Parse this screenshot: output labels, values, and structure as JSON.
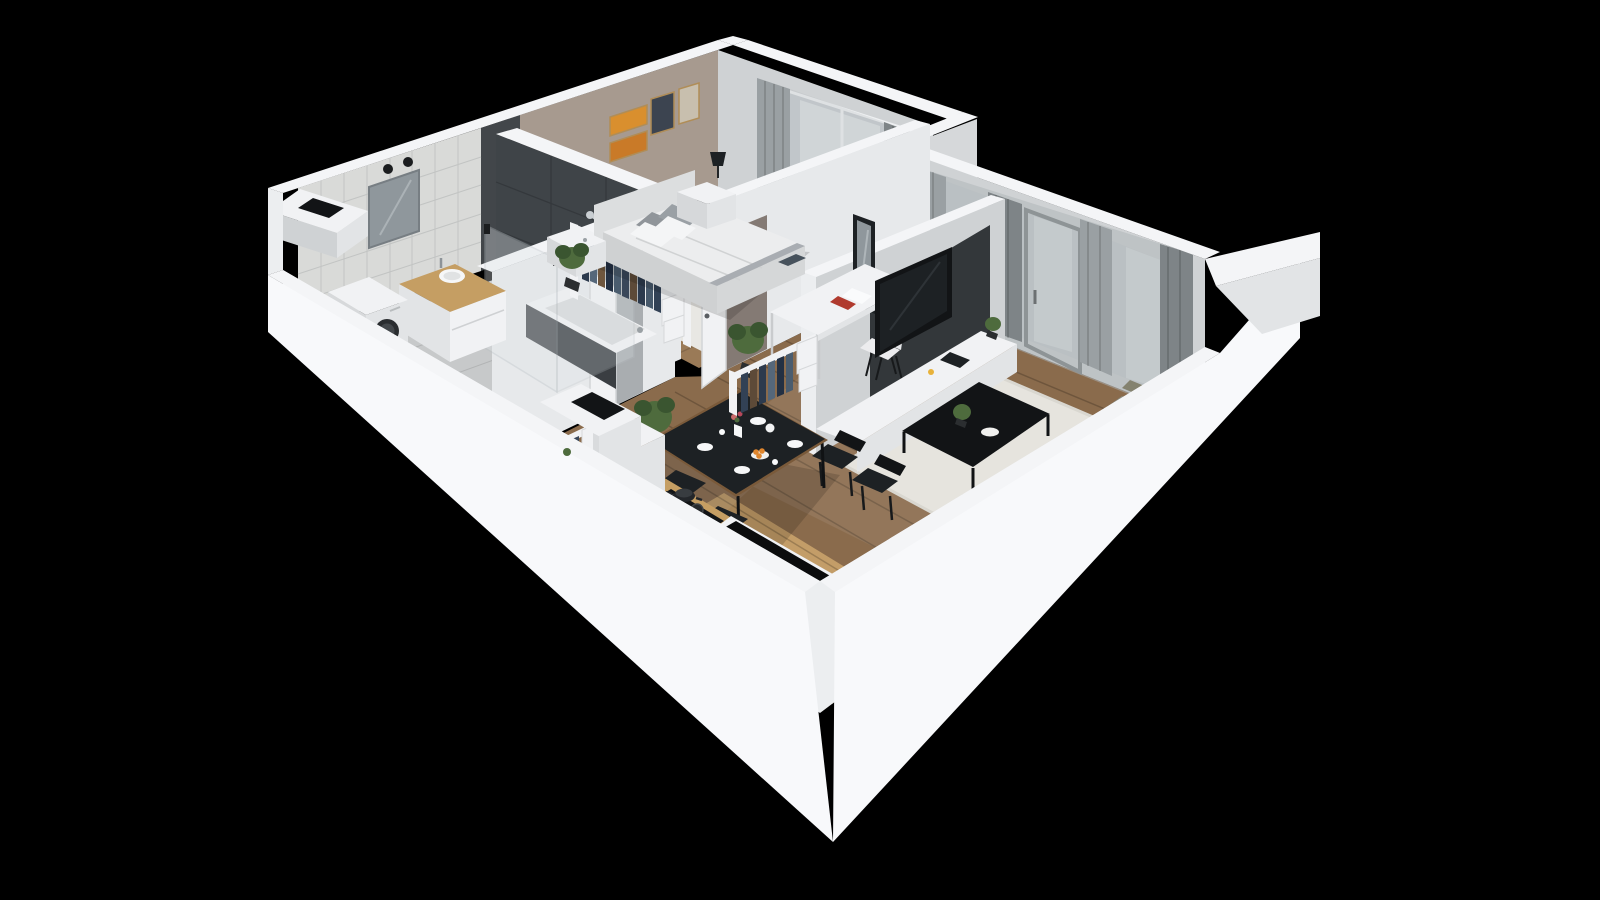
{
  "meta": {
    "image_type": "3d-isometric-cutaway-floorplan-render",
    "visible_text": "none",
    "background": "#000000"
  },
  "colors": {
    "bg": "#000000",
    "wallTop": "#f4f5f7",
    "wallFace": "#e7e9eb",
    "wallFaceLight": "#eceef0",
    "wallFaceDim": "#cfd2d4",
    "wallSkirt": "#f8f9fb",
    "wallJog": "#d6d8da",
    "taupe": "#a79a8f",
    "tile": "#d9dad8",
    "tileLine": "#c2c4c3",
    "darkTile": "#3f4448",
    "woodMain": "#8a6b4c",
    "woodBed": "#9a7a57",
    "woodLight": "#c9a36b",
    "woodCounter": "#c59e63",
    "rugWhite": "#e8e7e3",
    "shagRug": "#e6e4de",
    "bathFloor": "#c7c9ca",
    "glass": "#c7cdd0",
    "glassBright": "#dbe0e2",
    "curtain": "#9aa0a3",
    "curtainDark": "#7e8487",
    "sheer": "#aeb4b6",
    "black": "#121416",
    "blackSoft": "#1d2124",
    "panelDark": "#33373a",
    "sofaBody": "#8a887a",
    "sofaDark": "#6f6d5e",
    "sofaBack": "#7f7d6d",
    "pillowBlue": "#47525c",
    "green": "#4e6b3d",
    "greenDark": "#3a5530",
    "pot": "#2b2e30",
    "white": "#f1f2f4",
    "offWhite": "#e2e4e6",
    "frameGold": "#b08d57",
    "orange": "#e0862d",
    "red": "#b03a2e",
    "mirror": "#8f979c"
  },
  "scene": {
    "style": "cutaway apartment 3D floor plan, viewed from south-east, black background, no labels",
    "rooms": [
      {
        "name": "bathroom",
        "items": [
          "white-tiled-wall",
          "dark-tiled-tub-wall",
          "bathtub",
          "shower-glass-enclosure",
          "shower-mixer",
          "vanity-cabinet-wood-top",
          "vessel-sink",
          "wall-mirror-with-sconces",
          "washing-machine",
          "vent-shaft"
        ]
      },
      {
        "name": "bedroom",
        "items": [
          "double-bed-white-duvet",
          "headboard",
          "gray-and-white-pillows",
          "blue-cushion",
          "gray-throw",
          "nightstand-with-lamp",
          "nightstand",
          "potted-plant",
          "four-framed-pictures",
          "open-wardrobe-rack",
          "window-with-curtains",
          "white-rug"
        ]
      },
      {
        "name": "hallway",
        "items": [
          "open-wardrobe-rack-1",
          "open-wardrobe-rack-2",
          "folded-clothes-boxes",
          "potted-plant",
          "bathroom-door",
          "bedroom-door",
          "duct-shaft-box",
          "plank-wood-floor"
        ]
      },
      {
        "name": "workspace-nook",
        "items": [
          "white-desk",
          "desk-chair",
          "books-and-papers",
          "standing-mirror",
          "potted-plant",
          "curtained-window"
        ]
      },
      {
        "name": "living-room",
        "items": [
          "sofa-olive-gray",
          "blue-pillow",
          "black-coffee-table",
          "coffee-table-plant",
          "white-shag-rug",
          "tv-on-dark-panel",
          "white-media-console",
          "console-plant",
          "curtain-window-wall",
          "balcony-door",
          "balcony-side-wing"
        ]
      },
      {
        "name": "dining-area",
        "items": [
          "black-dining-table",
          "four-black-chairs",
          "white-plates",
          "cups-and-teapot",
          "flower-vase",
          "bowl-of-oranges"
        ]
      },
      {
        "name": "kitchen",
        "items": [
          "hob-counter-wood-top",
          "induction-hob",
          "cooking-pot",
          "tall-white-cabinet",
          "black-sink-with-faucet",
          "sink-counter-wood-top",
          "black-corner-unit",
          "light-wood-floor-zone"
        ]
      }
    ]
  }
}
